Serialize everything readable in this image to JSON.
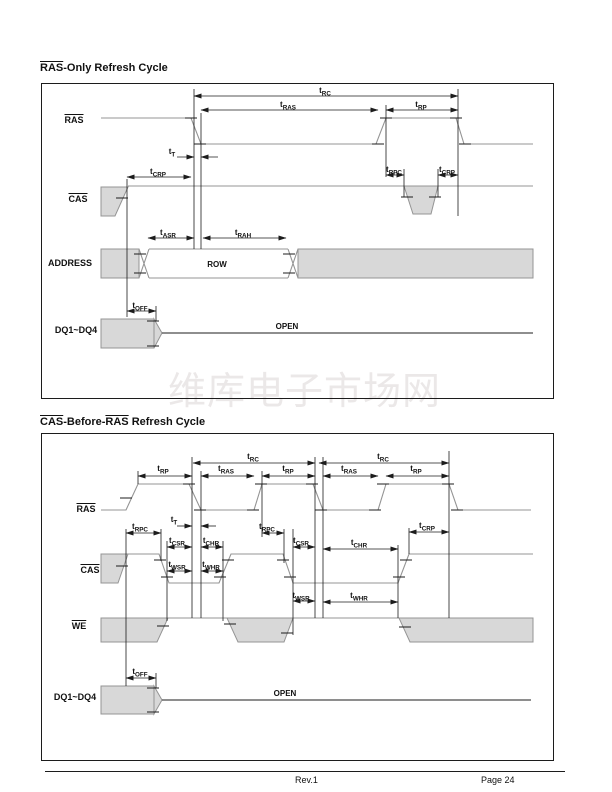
{
  "page": {
    "watermark": "维库电子市场网",
    "footer": {
      "revision": "Rev.1",
      "page_number": "Page 24"
    }
  },
  "colors": {
    "waveform_stroke": "#949494",
    "dont_care_fill": "#d8d8d8",
    "dimension_line": "#1c1c1c"
  },
  "section1": {
    "title": {
      "overlined": "RAS",
      "rest": "-Only Refresh Cycle"
    },
    "signals": {
      "ras": "RAS",
      "cas": "CAS",
      "address": "ADDRESS",
      "dq": "DQ1~DQ4"
    },
    "bus": {
      "row": "ROW",
      "open": "OPEN"
    },
    "timing": {
      "trc": "tRC",
      "tras": "tRAS",
      "trp": "tRP",
      "tt": "tT",
      "tcrp_left": "tCRP",
      "trpc": "tRPC",
      "tcrp_right": "tCRP",
      "tasr": "tASR",
      "trah": "tRAH",
      "toff": "tOFF"
    }
  },
  "section2": {
    "title": {
      "overlined1": "CAS",
      "mid": "-Before-",
      "overlined2": "RAS",
      "rest": " Refresh Cycle"
    },
    "signals": {
      "ras": "RAS",
      "cas": "CAS",
      "we": "WE",
      "dq": "DQ1~DQ4"
    },
    "bus": {
      "open": "OPEN"
    },
    "timing": {
      "trp1": "tRP",
      "trc1": "tRC",
      "tras1": "tRAS",
      "trp2": "tRP",
      "trc2": "tRC",
      "tras2": "tRAS",
      "trp3": "tRP",
      "tt": "tT",
      "trpc1": "tRPC",
      "tcsr1": "tCSR",
      "tchr1": "tCHR",
      "trpc2": "tRPC",
      "tcsr2": "tCSR",
      "tchr2": "tCHR",
      "tcrp": "tCRP",
      "twsr1": "tWSR",
      "twhr1": "tWHR",
      "twsr2": "tWSR",
      "twhr2": "tWHR",
      "toff": "tOFF"
    }
  }
}
